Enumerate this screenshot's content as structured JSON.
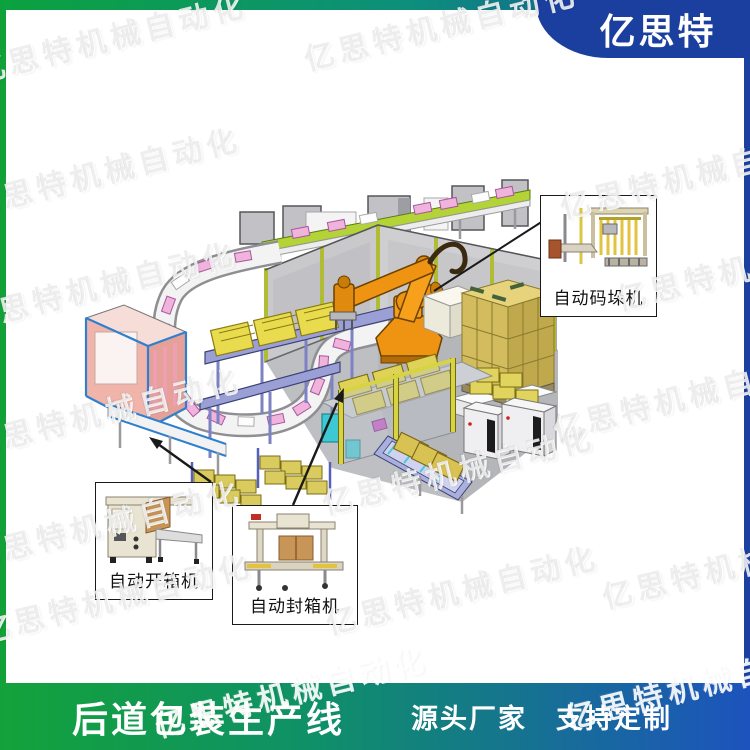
{
  "brand": {
    "logo_text": "亿思特",
    "watermark": "亿思特机械自动化"
  },
  "banner_bottom": {
    "title": "后道包装生产线",
    "subtitle": "源头厂家　支持定制"
  },
  "callouts": [
    {
      "id": "palletizer",
      "label": "自动码垛机"
    },
    {
      "id": "case-opener",
      "label": "自动开箱机"
    },
    {
      "id": "case-sealer",
      "label": "自动封箱机"
    }
  ],
  "colors": {
    "brand_green": "#12a038",
    "brand_blue": "#1b3f9e",
    "banner_gradient_start": "#13a23a",
    "banner_gradient_end": "#1d53bd",
    "robot_orange": "#ef9313",
    "carton_yellow": "#d9cb5e",
    "belt_lime": "#b3d337",
    "accent_pink": "#efb3dc",
    "accent_cyan": "#3cc9d3",
    "wall_gray": "#c9c9cc"
  }
}
